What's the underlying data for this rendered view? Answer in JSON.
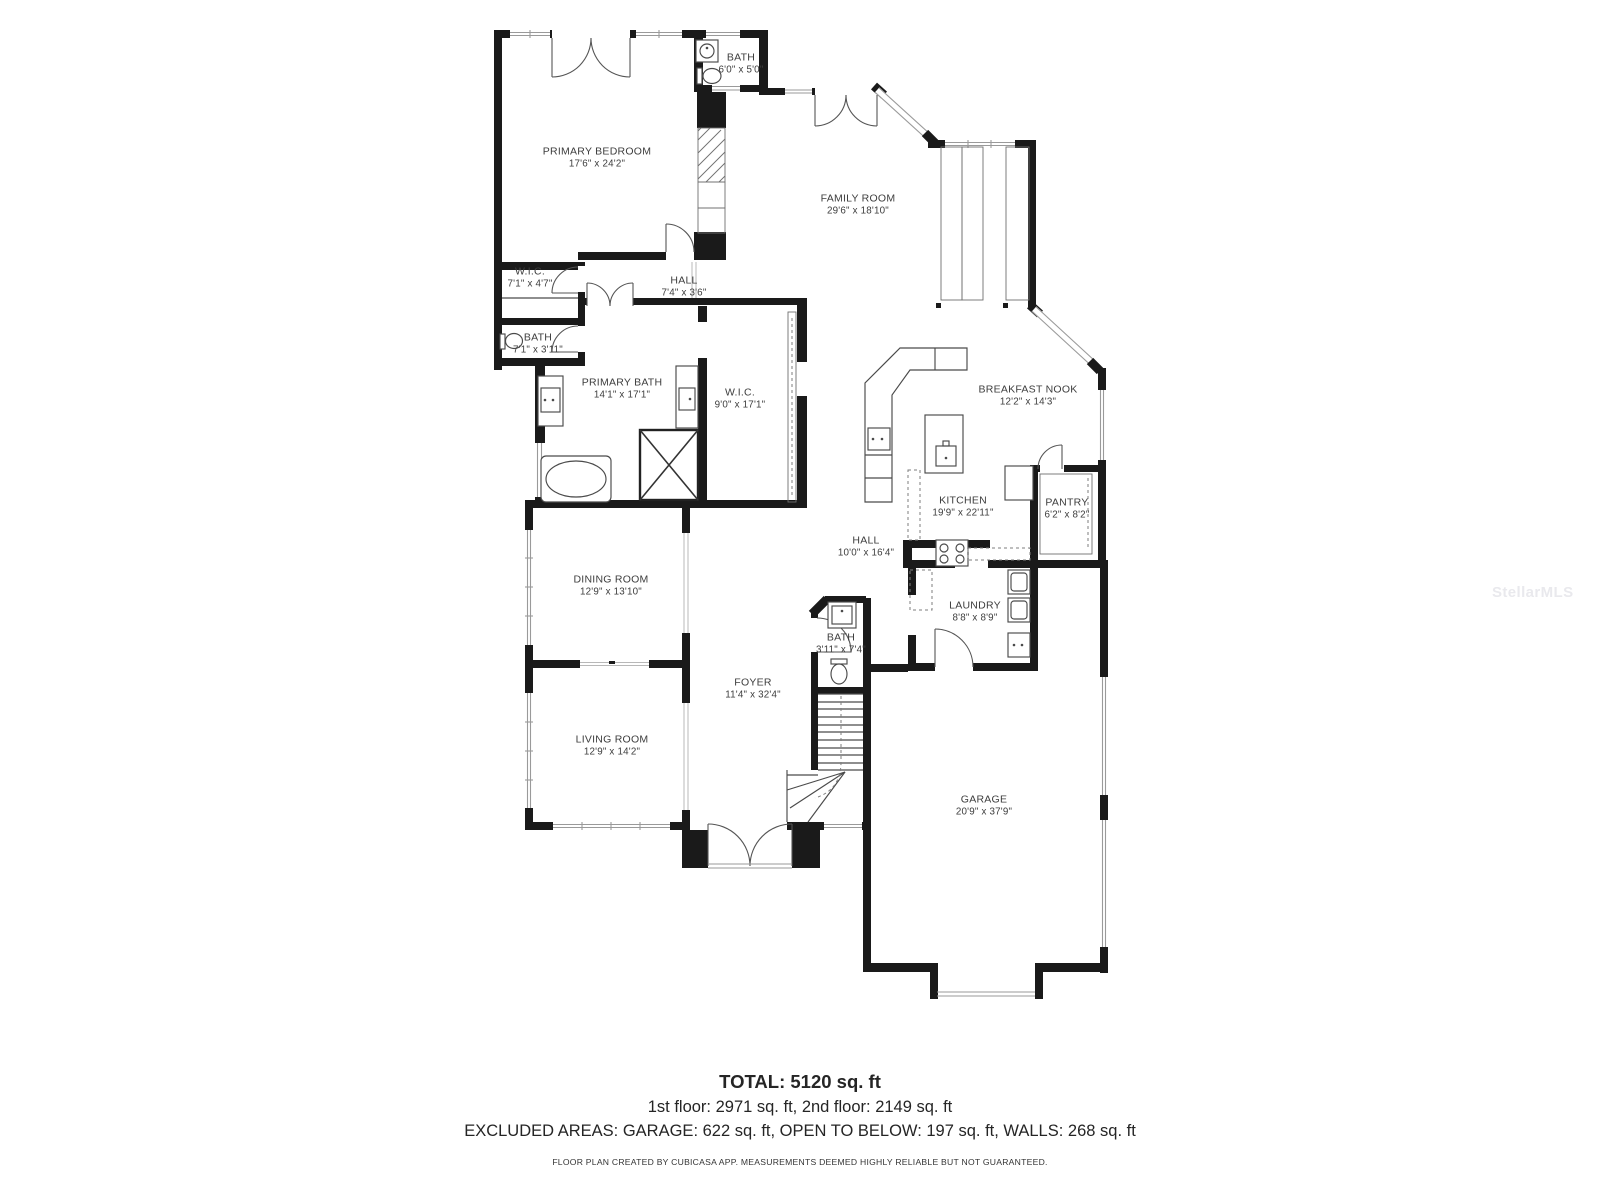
{
  "floor_plan": {
    "watermark": "StellarMLS",
    "summary": {
      "total": "TOTAL: 5120 sq. ft",
      "floors": "1st floor: 2971 sq. ft, 2nd floor: 2149 sq. ft",
      "excluded": "EXCLUDED AREAS: GARAGE: 622 sq. ft, OPEN TO BELOW: 197 sq. ft, WALLS: 268 sq. ft",
      "disclaimer": "FLOOR PLAN CREATED BY CUBICASA APP. MEASUREMENTS DEEMED HIGHLY RELIABLE BUT NOT GUARANTEED."
    },
    "rooms": [
      {
        "name": "PRIMARY BEDROOM",
        "dims": "17'6\" x 24'2\"",
        "x": 597,
        "y": 158
      },
      {
        "name": "BATH",
        "dims": "6'0\" x 5'0\"",
        "x": 741,
        "y": 64
      },
      {
        "name": "FAMILY ROOM",
        "dims": "29'6\" x 18'10\"",
        "x": 858,
        "y": 205
      },
      {
        "name": "W.I.C.",
        "dims": "7'1\" x 4'7\"",
        "x": 530,
        "y": 278
      },
      {
        "name": "HALL",
        "dims": "7'4\" x 3'6\"",
        "x": 684,
        "y": 287
      },
      {
        "name": "BATH",
        "dims": "7'1\" x 3'11\"",
        "x": 538,
        "y": 344
      },
      {
        "name": "PRIMARY BATH",
        "dims": "14'1\" x 17'1\"",
        "x": 622,
        "y": 389
      },
      {
        "name": "W.I.C.",
        "dims": "9'0\" x 17'1\"",
        "x": 740,
        "y": 399
      },
      {
        "name": "BREAKFAST NOOK",
        "dims": "12'2\" x 14'3\"",
        "x": 1028,
        "y": 396
      },
      {
        "name": "KITCHEN",
        "dims": "19'9\" x 22'11\"",
        "x": 963,
        "y": 507
      },
      {
        "name": "PANTRY",
        "dims": "6'2\" x 8'2\"",
        "x": 1067,
        "y": 509
      },
      {
        "name": "HALL",
        "dims": "10'0\" x 16'4\"",
        "x": 866,
        "y": 547
      },
      {
        "name": "LAUNDRY",
        "dims": "8'8\" x 8'9\"",
        "x": 975,
        "y": 612
      },
      {
        "name": "BATH",
        "dims": "3'11\" x 7'4\"",
        "x": 841,
        "y": 644
      },
      {
        "name": "DINING ROOM",
        "dims": "12'9\" x 13'10\"",
        "x": 611,
        "y": 586
      },
      {
        "name": "FOYER",
        "dims": "11'4\" x 32'4\"",
        "x": 753,
        "y": 689
      },
      {
        "name": "LIVING ROOM",
        "dims": "12'9\" x 14'2\"",
        "x": 612,
        "y": 746
      },
      {
        "name": "GARAGE",
        "dims": "20'9\" x 37'9\"",
        "x": 984,
        "y": 806
      }
    ]
  }
}
